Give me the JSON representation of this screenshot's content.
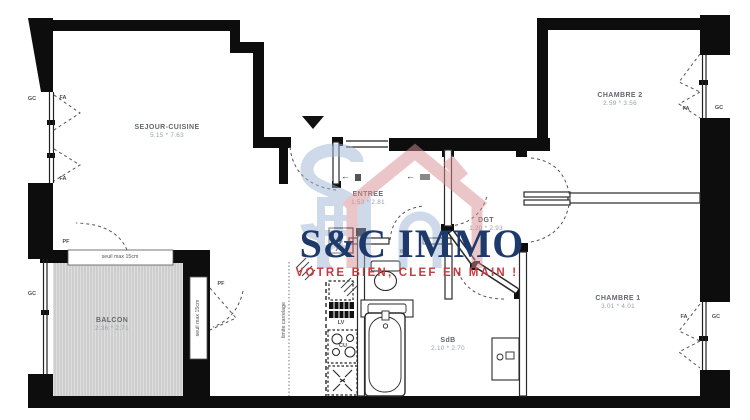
{
  "watermark": {
    "brand": "S&C IMMO",
    "tagline": "VOTRE BIEN, CLEF EN MAIN !"
  },
  "rooms": {
    "sejour_cuisine": {
      "name": "SEJOUR-CUISINE",
      "dims": "5.15 * 7.63"
    },
    "chambre_2": {
      "name": "CHAMBRE 2",
      "dims": "2.59 * 3.56"
    },
    "chambre_1": {
      "name": "CHAMBRE 1",
      "dims": "3.01 * 4.01"
    },
    "entree": {
      "name": "ENTREE",
      "dims": "1.53 * 2.81"
    },
    "degagement": {
      "name": "DGT",
      "dims": "1.20 * 2.93"
    },
    "salle_de_bains": {
      "name": "SdB",
      "dims": "2.10 * 2.70"
    },
    "wc": {
      "name": "WC"
    },
    "balcon": {
      "name": "BALCON",
      "dims": "2.36 * 2.71"
    }
  },
  "annotations": {
    "gc": "GC",
    "fa": "FA",
    "pf": "PF",
    "lv": "LV",
    "cu": "CU",
    "seuil": "seuil max 15cm",
    "limite_carrelage": "limite carrelage",
    "entry_arrow": "←"
  },
  "colors": {
    "wall": "#0d0d0d",
    "room_label": "#63676f",
    "dims_label": "#999fa8",
    "brand_navy": "#1d3a6b",
    "tagline_red": "#c9393e",
    "logo_pink": "#d98f93",
    "logo_blue": "#9fb4d6",
    "balcony_fill": "#dedede"
  }
}
